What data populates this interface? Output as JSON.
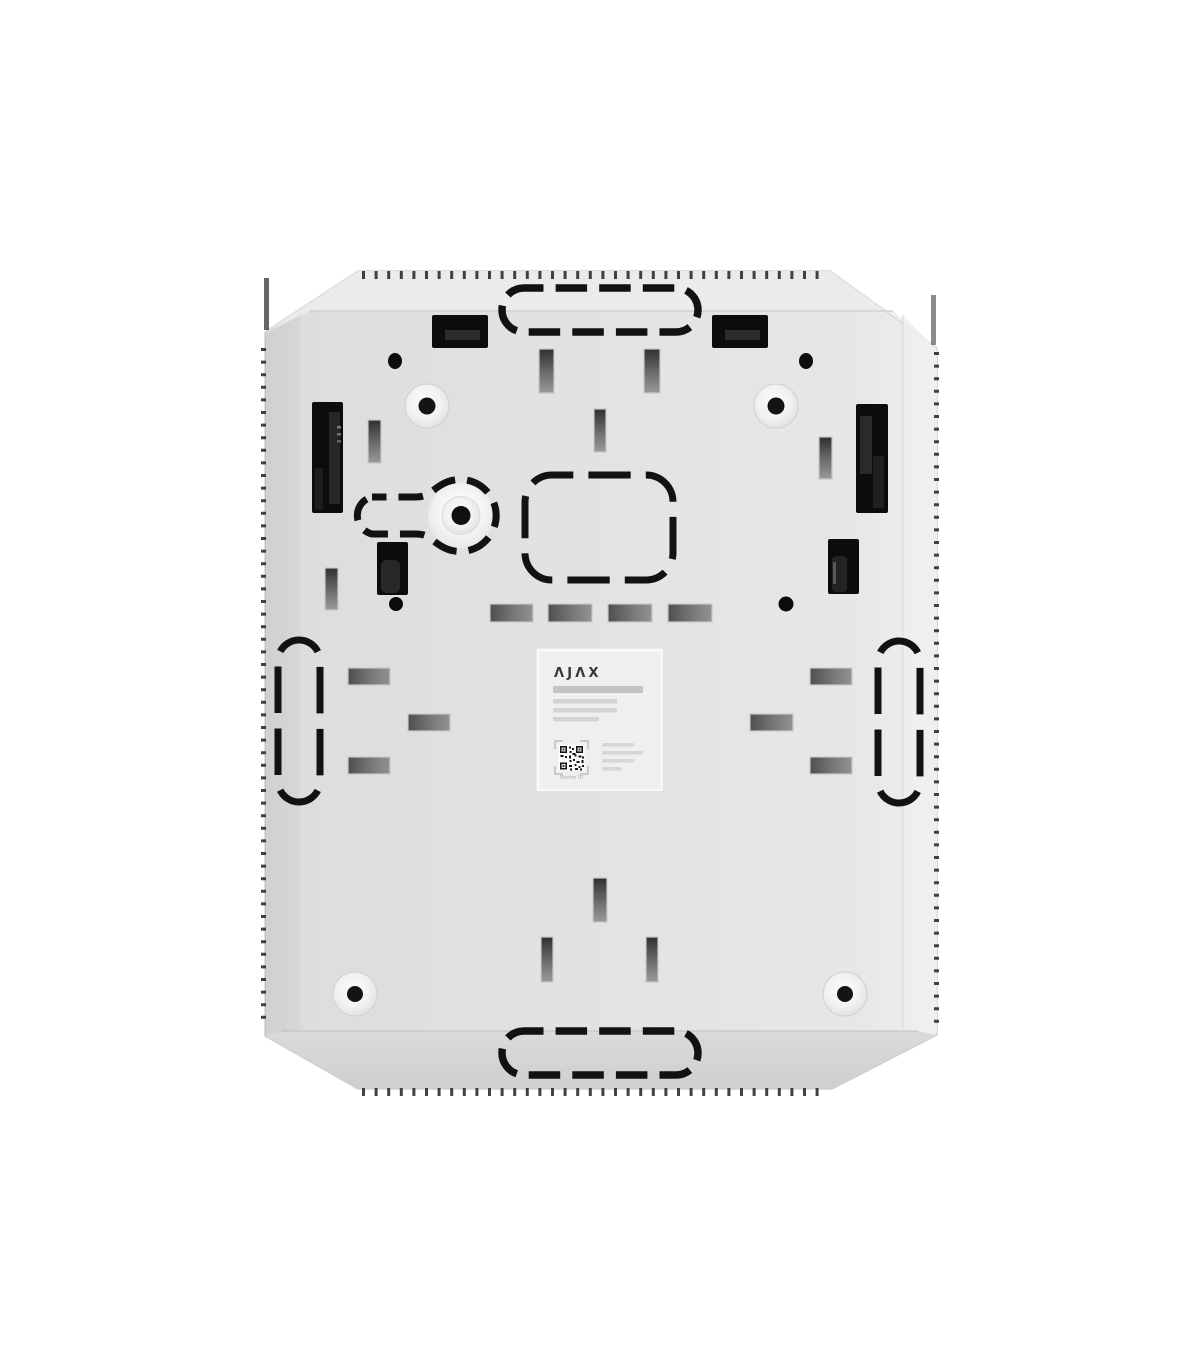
{
  "label": {
    "brand_logo": "ΛJΛX",
    "qr_caption": "Device ID"
  },
  "colors": {
    "background": "#ffffff",
    "panel_face": "#e3e3e3",
    "top_bevel": "#ececec",
    "bottom_bevel": "#d6d6d6",
    "perforation_stroke": "#121212",
    "cutout_black": "#0c0c0c",
    "label_background": "#efefef"
  }
}
